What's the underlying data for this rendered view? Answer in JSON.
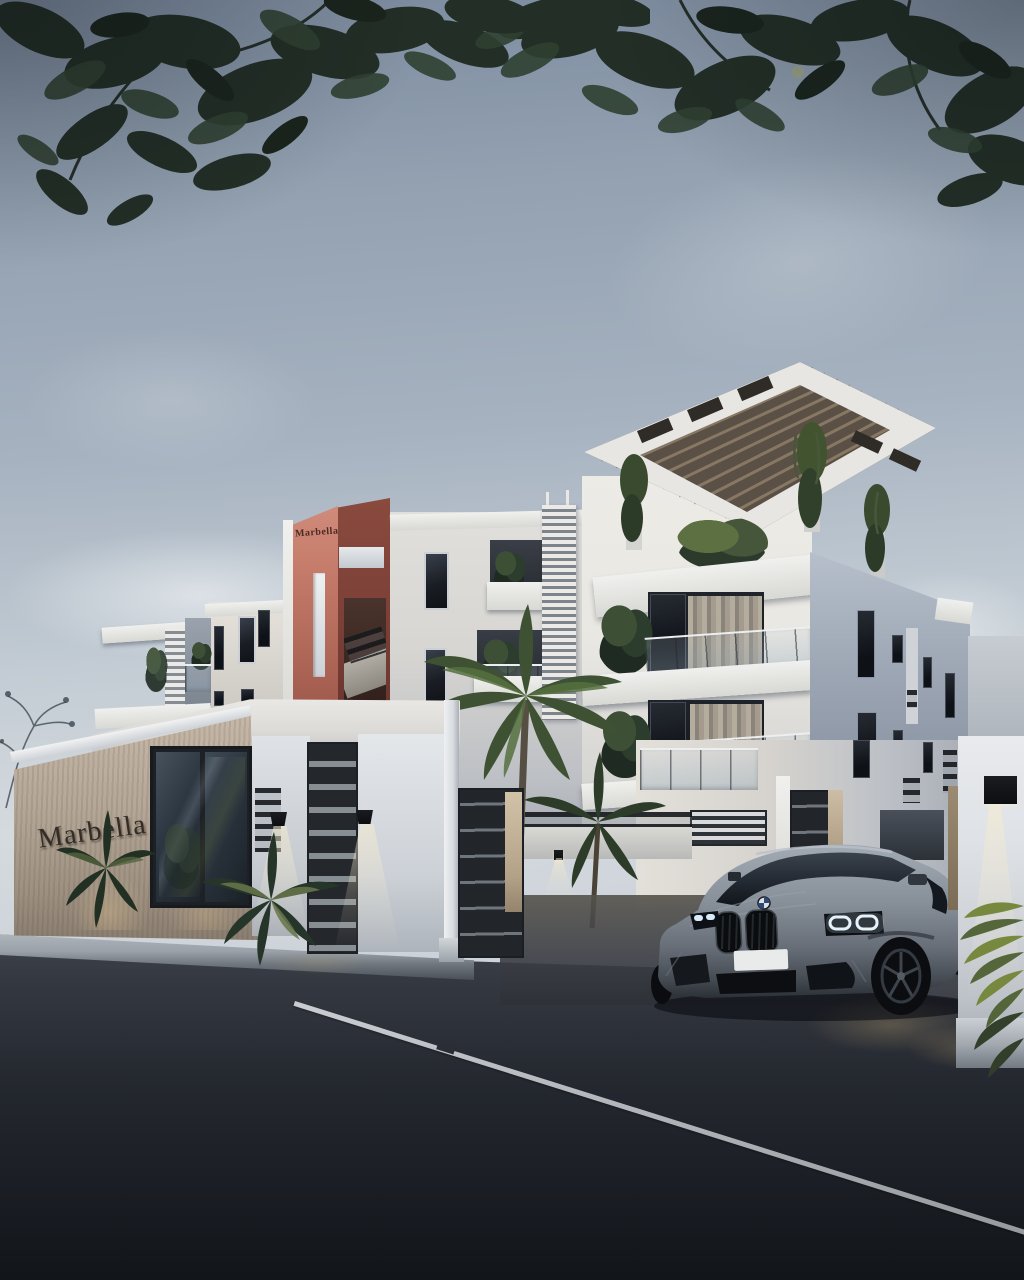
{
  "meta": {
    "description": "Dusk 3D architectural rendering of the Marbella residential apartment building with entrance gate, BMW SUV in the driveway and tropical landscaping"
  },
  "signs": {
    "wall_sign": "Marbella",
    "tower_sign": "Marbella"
  },
  "palette": {
    "sky_top": "#7b8a9e",
    "sky_mid": "#a6b2c0",
    "sky_low": "#d5dade",
    "foliage_dark": "#222e26",
    "foliage_mid": "#2f4031",
    "bldg_light": "#e9e7e2",
    "bldg_mid": "#d8d6d2",
    "bldg_shadow": "#a8b0bd",
    "side_face": "#9aa4b2",
    "tower_red": "#c47a69",
    "tower_red_dark": "#7c4037",
    "window_dark": "#1a1e24",
    "wood_wall": "#b9aa9a",
    "sign_letters": "#332d26",
    "gate_dark": "#24272c",
    "road": "#23262d",
    "curb": "#a8aeb4",
    "road_line": "#dbdfe3",
    "bmw_grey": "#99a1ab",
    "green_car": "#58bb49",
    "lamp_glow": "#f4e7c6"
  }
}
